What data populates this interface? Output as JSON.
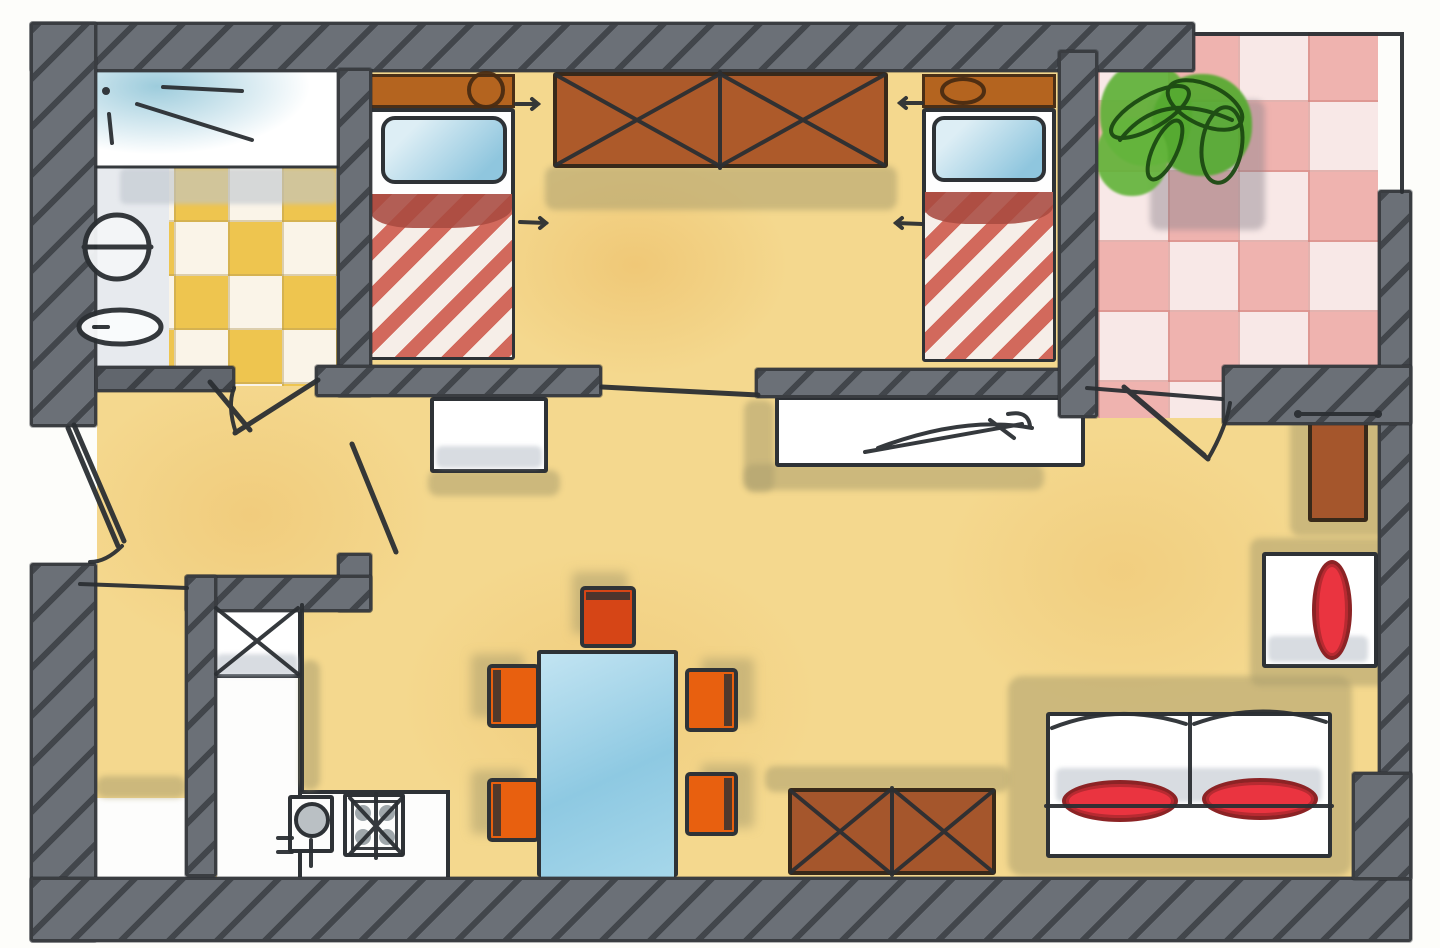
{
  "scene": {
    "label": "Hand-drawn watercolor apartment floor plan",
    "style": "ink and watercolor sketch, top-down view",
    "no_visible_text": true
  },
  "rooms": {
    "bathroom": {
      "label": "Bathroom",
      "fixtures": [
        "washbasin",
        "toilet",
        "shower pen-marks",
        "yellow checker tile floor"
      ]
    },
    "bedroom": {
      "label": "Bedroom",
      "furniture": [
        "single bed left",
        "single bed right",
        "double wardrobe with X panels"
      ]
    },
    "balcony": {
      "label": "Balcony terrace",
      "features": [
        "pink checker tile floor",
        "green plant",
        "thin railing"
      ]
    },
    "hall": {
      "label": "Entrance hall",
      "features": [
        "entry door swing",
        "bathroom door swing",
        "living room door swing"
      ]
    },
    "kitchen": {
      "label": "Kitchenette",
      "fixtures": [
        "tall cabinet with X",
        "L-shaped counter",
        "round sink",
        "4-burner stove"
      ]
    },
    "storage": {
      "label": "Storage room"
    },
    "living_room": {
      "label": "Living and dining room",
      "furniture": [
        "blue dining table",
        "five orange chairs",
        "brown sideboard with X panels",
        "white desk with pen scribble",
        "white shelf",
        "sofa with two red cushions",
        "armchair with red cushion",
        "small brown cabinet"
      ]
    }
  },
  "counts": {
    "chairs": 5,
    "beds": 2,
    "sofa_cushions": 2,
    "wardrobe_panels": 2,
    "sideboard_panels": 2
  },
  "palette": {
    "wall_fill": "#6b7077",
    "wall_line": "#3a3d41",
    "pen": "#2b2f33",
    "floor_yellow": "#f4d88e",
    "floor_patch": "#e9bd64",
    "bath_tile_gold": "#eec54f",
    "balcony_tile_pink": "#efb3af",
    "wood_brown": "#ad5a2a",
    "headboard_brown": "#b4641f",
    "blanket_stripe_red": "#d2695c",
    "blanket_band_dark": "#a84a40",
    "pillow_blue": "#86c3dd",
    "table_blue": "#9fd3e9",
    "chair_orange": "#e8600f",
    "chair_top_red": "#d64516",
    "cushion_red": "#ea3440",
    "plant_green": "#5fb138",
    "shadow_khaki": "#ac9e6e"
  }
}
